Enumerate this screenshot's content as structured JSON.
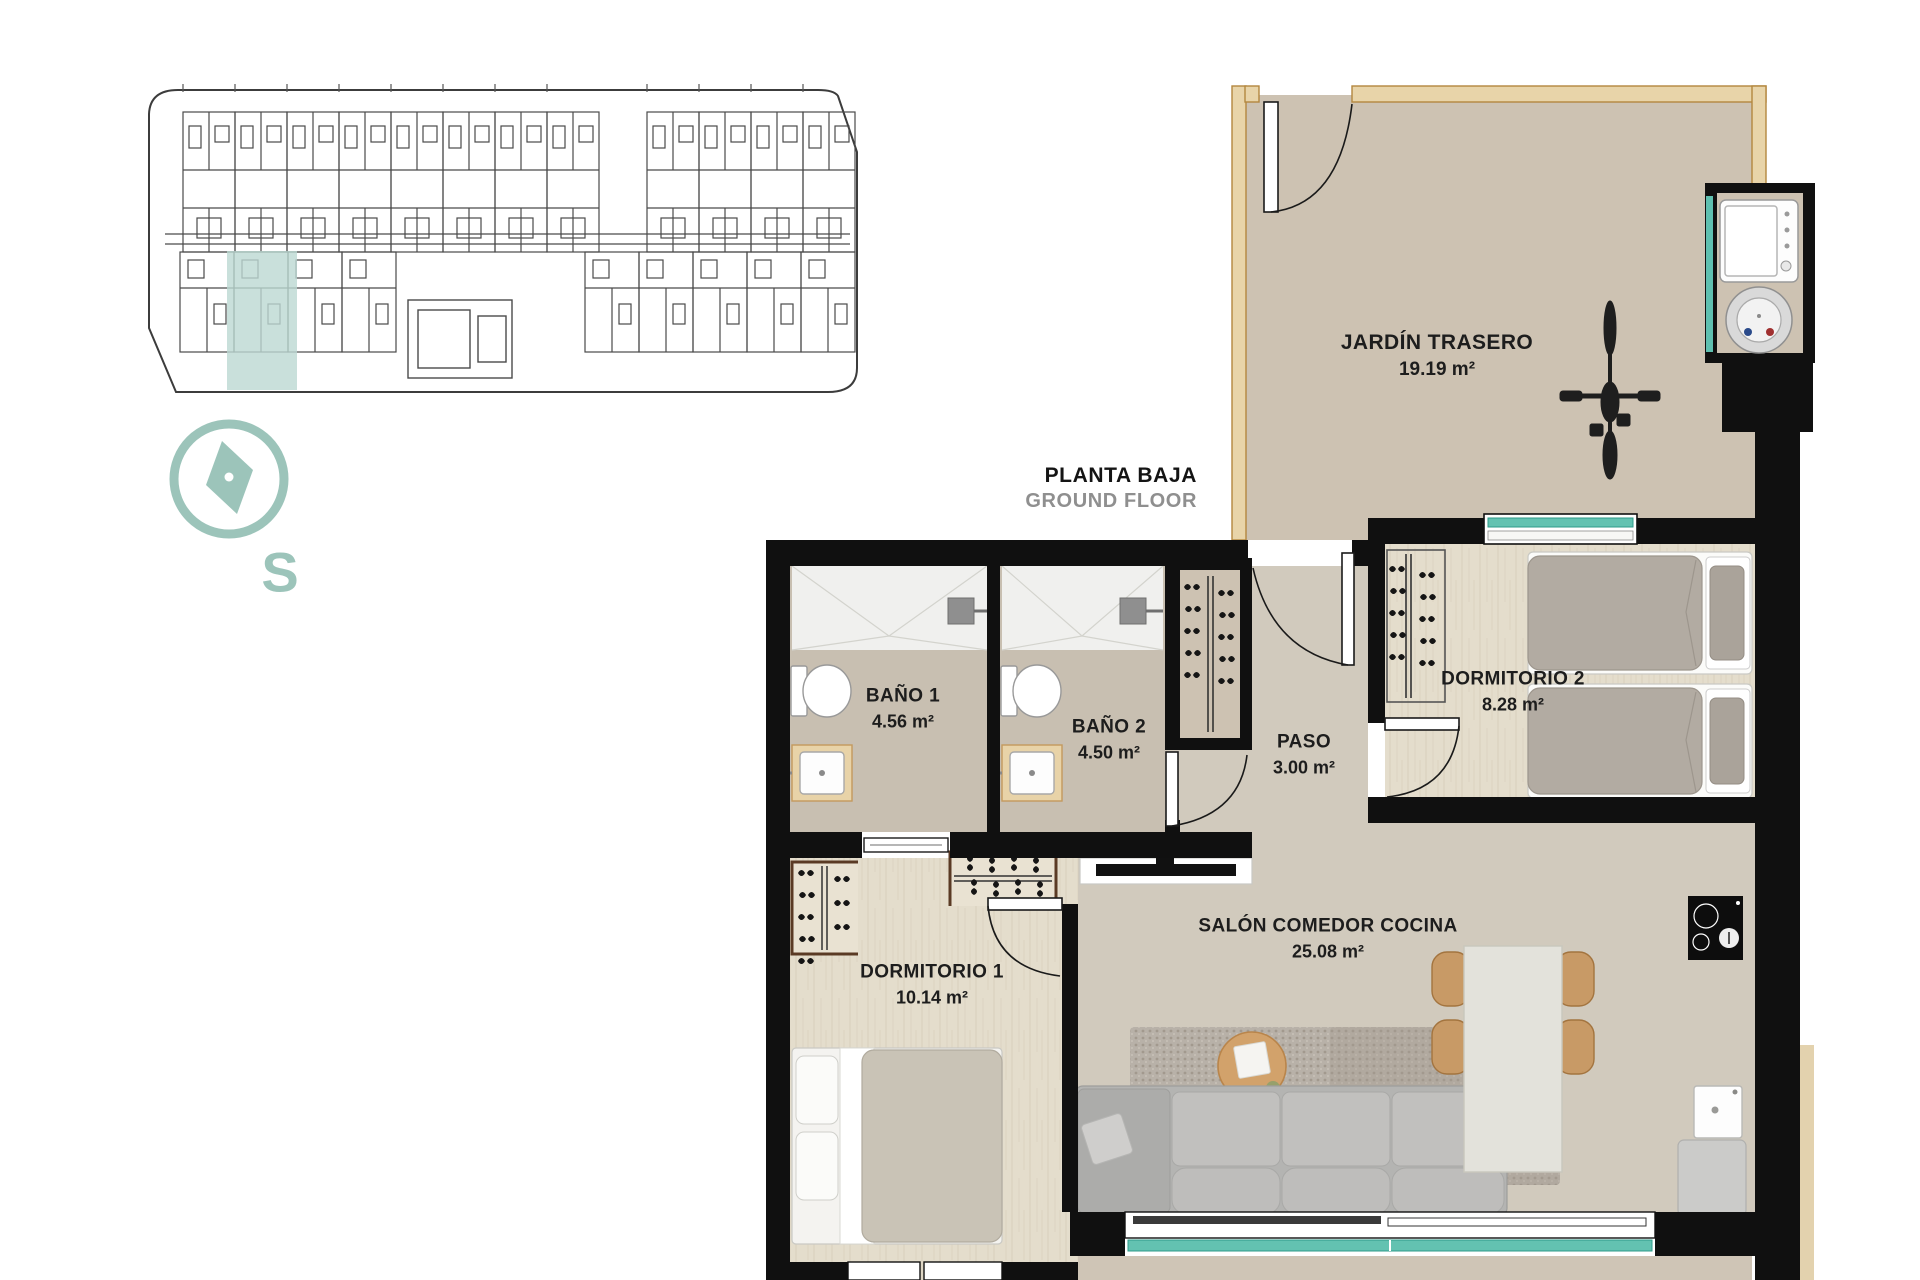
{
  "title": {
    "primary": "PLANTA BAJA",
    "secondary": "GROUND FLOOR"
  },
  "compass": {
    "cardinal_letter": "S"
  },
  "rooms": [
    {
      "id": "jardin-trasero",
      "name": "JARDÍN TRASERO",
      "area": "19.19 m²"
    },
    {
      "id": "bano-1",
      "name": "BAÑO 1",
      "area": "4.56 m²"
    },
    {
      "id": "bano-2",
      "name": "BAÑO 2",
      "area": "4.50 m²"
    },
    {
      "id": "paso",
      "name": "PASO",
      "area": "3.00 m²"
    },
    {
      "id": "dormitorio-2",
      "name": "DORMITORIO 2",
      "area": "8.28 m²"
    },
    {
      "id": "dormitorio-1",
      "name": "DORMITORIO 1",
      "area": "10.14 m²"
    },
    {
      "id": "salon-comedor-cocina",
      "name": "SALÓN COMEDOR COCINA",
      "area": "25.08 m²"
    }
  ],
  "colors": {
    "accent_teal": "#9cc4ba",
    "glass_teal": "#63c2b1",
    "highlighted_unit": "#bcd8d2",
    "wall_black": "#101010",
    "fence_tan": "#e8d4a9",
    "garden_floor": "#cdc2b2",
    "wood_floor": "#e4ddcc",
    "salon_floor": "#d1cabd"
  }
}
